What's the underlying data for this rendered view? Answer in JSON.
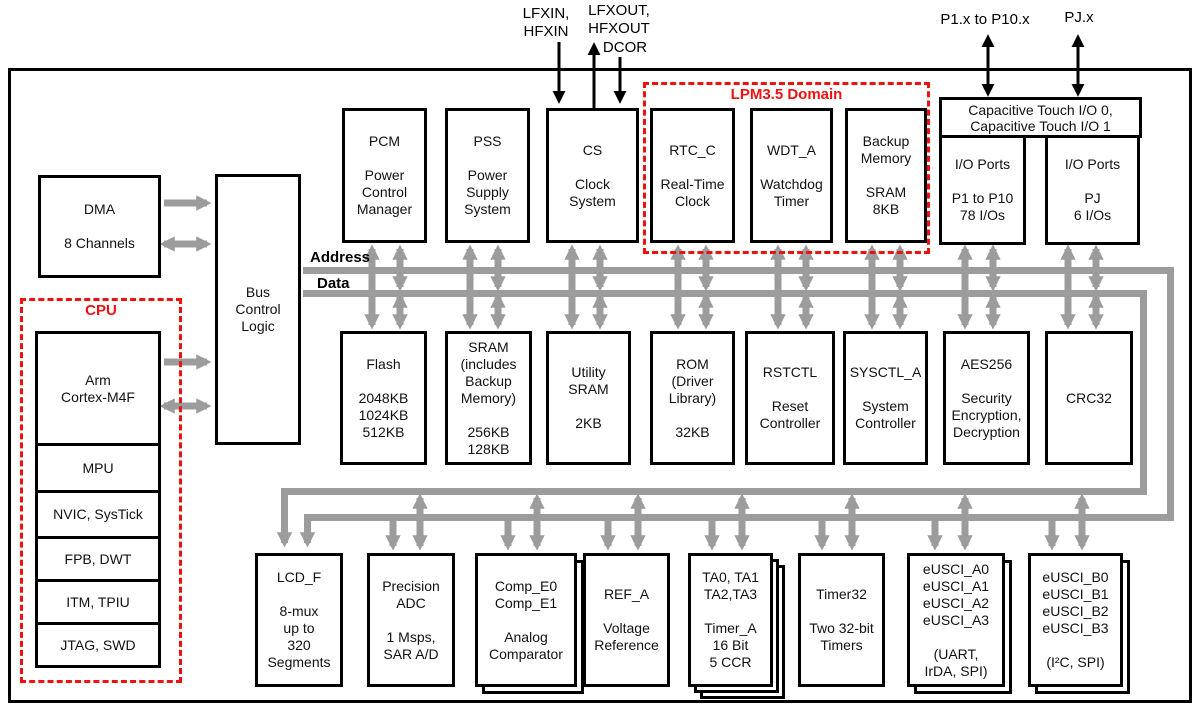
{
  "labels": {
    "lfxin": [
      "LFXIN,",
      "HFXIN"
    ],
    "lfxout": [
      "LFXOUT,",
      "HFXOUT"
    ],
    "dcor": "DCOR",
    "p1": "P1.x to P10.x",
    "pj": "PJ.x",
    "address": "Address",
    "data": "Data",
    "cpu_domain": "CPU",
    "lpm_domain": "LPM3.5 Domain"
  },
  "blocks": {
    "dma": [
      "DMA",
      "",
      "8 Channels"
    ],
    "bus_control": [
      "Bus",
      "Control",
      "Logic"
    ],
    "cortex": [
      "Arm",
      "Cortex-M4F"
    ],
    "mpu": [
      "MPU"
    ],
    "nvic": [
      "NVIC, SysTick"
    ],
    "fpb": [
      "FPB, DWT"
    ],
    "itm": [
      "ITM, TPIU"
    ],
    "jtag": [
      "JTAG, SWD"
    ],
    "pcm": [
      "PCM",
      "",
      "Power",
      "Control",
      "Manager"
    ],
    "pss": [
      "PSS",
      "",
      "Power",
      "Supply",
      "System"
    ],
    "cs": [
      "CS",
      "",
      "Clock",
      "System"
    ],
    "rtc": [
      "RTC_C",
      "",
      "Real-Time",
      "Clock"
    ],
    "wdt": [
      "WDT_A",
      "",
      "Watchdog",
      "Timer"
    ],
    "backup_memory": [
      "Backup",
      "Memory",
      "",
      "SRAM",
      "8KB"
    ],
    "cap_touch": [
      "Capacitive Touch I/O 0,",
      "Capacitive Touch I/O 1"
    ],
    "io_ports_p": [
      "I/O Ports",
      "",
      "P1 to P10",
      "78 I/Os"
    ],
    "io_ports_pj": [
      "I/O Ports",
      "",
      "PJ",
      "6 I/Os"
    ],
    "flash": [
      "Flash",
      "",
      "2048KB",
      "1024KB",
      "512KB"
    ],
    "sram": [
      "SRAM",
      "(includes",
      "Backup",
      "Memory)",
      "",
      "256KB",
      "128KB"
    ],
    "utility_sram": [
      "Utility",
      "SRAM",
      "",
      "2KB"
    ],
    "rom": [
      "ROM",
      "(Driver",
      "Library)",
      "",
      "32KB"
    ],
    "rstctl": [
      "RSTCTL",
      "",
      "Reset",
      "Controller"
    ],
    "sysctl": [
      "SYSCTL_A",
      "",
      "System",
      "Controller"
    ],
    "aes": [
      "AES256",
      "",
      "Security",
      "Encryption,",
      "Decryption"
    ],
    "crc": [
      "CRC32"
    ],
    "lcd": [
      "LCD_F",
      "",
      "8-mux",
      "up to",
      "320",
      "Segments"
    ],
    "adc": [
      "Precision",
      "ADC",
      "",
      "1 Msps,",
      "SAR A/D"
    ],
    "comp": [
      "Comp_E0",
      "Comp_E1",
      "",
      "Analog",
      "Comparator"
    ],
    "ref": [
      "REF_A",
      "",
      "Voltage",
      "Reference"
    ],
    "timer_a": [
      "TA0, TA1",
      "TA2,TA3",
      "",
      "Timer_A",
      "16 Bit",
      "5 CCR"
    ],
    "timer32": [
      "Timer32",
      "",
      "Two 32-bit",
      "Timers"
    ],
    "eusci_a": [
      "eUSCI_A0",
      "eUSCI_A1",
      "eUSCI_A2",
      "eUSCI_A3",
      "",
      "(UART,",
      "IrDA, SPI)"
    ],
    "eusci_b": [
      "eUSCI_B0",
      "eUSCI_B1",
      "eUSCI_B2",
      "eUSCI_B3",
      "",
      "(I²C, SPI)"
    ]
  },
  "colors": {
    "domain_red": "#ee1111",
    "bus_gray": "#9c9c9c",
    "line_black": "#000000",
    "background": "#ffffff"
  }
}
